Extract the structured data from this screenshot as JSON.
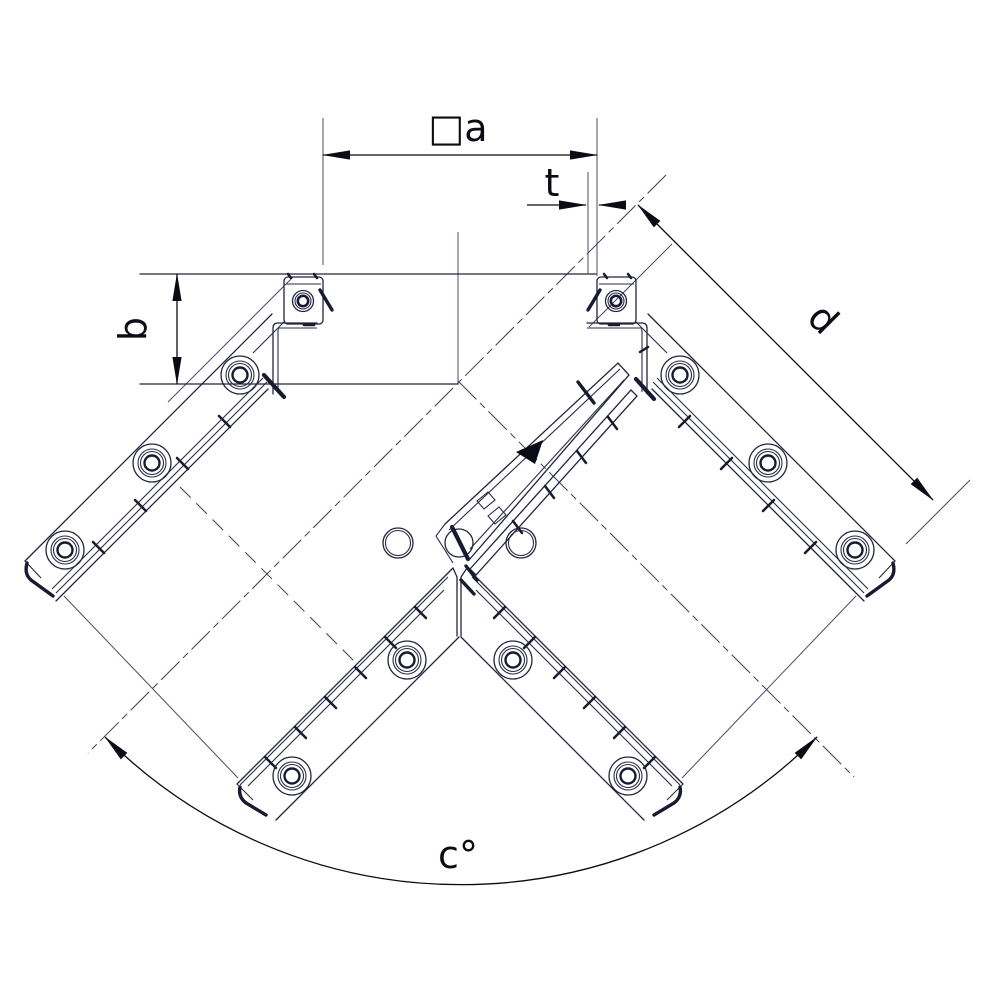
{
  "drawing": {
    "title": "corner-joint-technical-drawing",
    "labels": {
      "width": "□a",
      "thickness": "t",
      "height": "b",
      "diagonal": "d",
      "angle": "c°"
    },
    "colors": {
      "background": "#ffffff",
      "part_line": "#23233d",
      "thin_line": "#4b4b68",
      "dimension_line": "#0b0b15"
    }
  }
}
